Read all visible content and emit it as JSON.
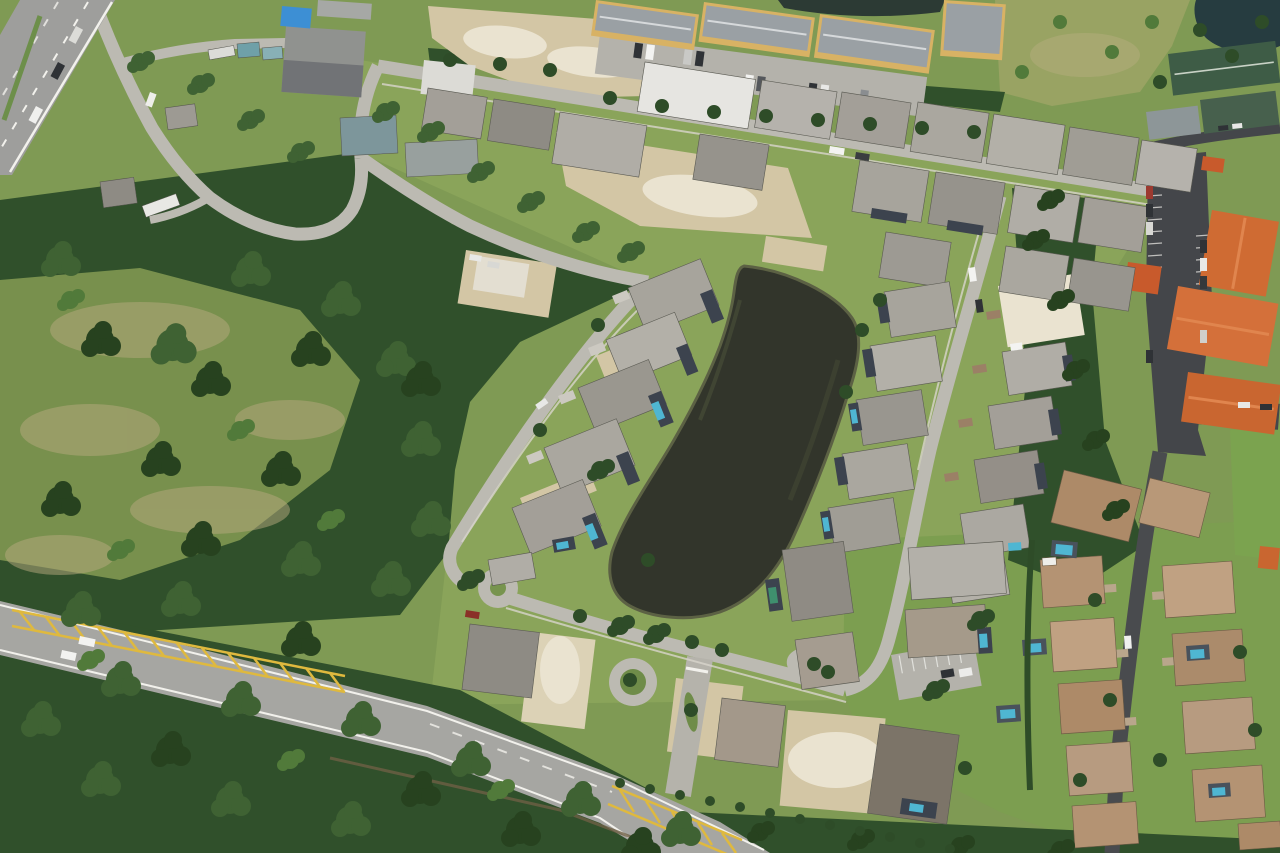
{
  "scene": {
    "type": "aerial-photograph",
    "description": "Aerial view of a Florida suburban residential development: dark retention pond in center ringed by rows of gray-roofed single-family homes and cleared construction lots, dense woodland to the left, an arterial road with yellow hatched median crossing the lower left, a divided highway in the top-left corner, yellow three-story apartment buildings along the top, orange tile-roof condominiums with dark asphalt parking on the right, and a tan tile-roof neighborhood in the bottom right.",
    "landmarks": {
      "highway": "divided highway, top left corner",
      "woodland": "dense tree cover, left side and bottom",
      "retention_pond": "dark diagonal retention pond, center",
      "new_home_rows": "rows of gray-roof homes flanking the pond",
      "construction_lots": "cleared tan dirt lots and home under construction",
      "apartments": "yellow three-story apartment buildings with parking, top",
      "orange_condos": "orange tile-roof condo buildings with dark parking lot, right edge",
      "tan_roof_neighborhood": "tan tile-roof homes with screened pools, bottom right",
      "arterial_road": "two-lane road with yellow hatched median, bottom left",
      "community_entrance": "landscaped entrance with round island and median islands"
    }
  },
  "colors": {
    "grass": "#7f9a54",
    "lawn": "#8aa45a",
    "lawn_right": "#7c9e50",
    "field": "#99a363",
    "forest": "#30502b",
    "canopy": "#3f6233",
    "canopy_dark": "#27421f",
    "canopy_light": "#517a3a",
    "dirt": "#d3c6a5",
    "dirt_bright": "#eae3d0",
    "water": "#32352b",
    "water_edge": "#5c6144",
    "water_ne": "#263c40",
    "water_apt": "#2c3a34",
    "street": "#bcbab2",
    "road": "#a6a6a2",
    "road_line": "#f2f1ec",
    "road_yellow": "#dfb93e",
    "asphalt": "#44464a",
    "sidewalk": "#d8d5cc",
    "roof_gray": "#a39f98",
    "roof_light": "#b5b2ac",
    "roof_dark": "#8e8b84",
    "roof_white": "#e6e5e1",
    "roof_tan": "#b49373",
    "roof_orange": "#cf6b33",
    "roof_green": "#3e5c46",
    "apt_wall": "#d8b264",
    "apt_roof": "#9aa0a4",
    "lanai": "#3c434e",
    "pool": "#4fb6d2",
    "car_white": "#f3f3f1",
    "car_dark": "#2f3236"
  }
}
